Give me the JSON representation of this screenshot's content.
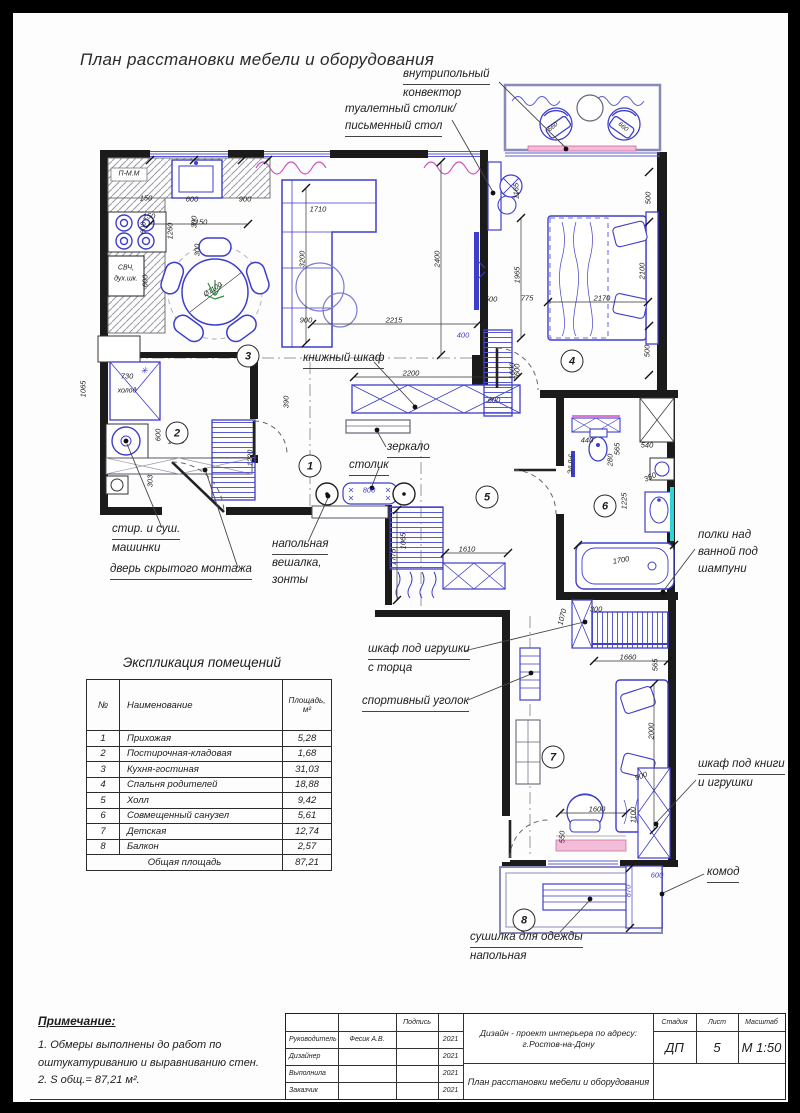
{
  "page": {
    "title": "План расстановки мебели и оборудования"
  },
  "colors": {
    "furniture_blue": "#3e3ecb",
    "wall_black": "#1b1b1b",
    "accent_magenta": "#cf4fc4",
    "accent_pink": "#f3bcd9",
    "accent_teal": "#2fd4d4",
    "plant_green": "#2f8f3f"
  },
  "plan": {
    "room_numbers": [
      {
        "n": "1",
        "x": 310,
        "y": 466
      },
      {
        "n": "2",
        "x": 177,
        "y": 433
      },
      {
        "n": "3",
        "x": 248,
        "y": 356
      },
      {
        "n": "4",
        "x": 572,
        "y": 361
      },
      {
        "n": "5",
        "x": 487,
        "y": 497
      },
      {
        "n": "6",
        "x": 605,
        "y": 506
      },
      {
        "n": "7",
        "x": 553,
        "y": 757
      },
      {
        "n": "8",
        "x": 524,
        "y": 920
      }
    ],
    "small_labels": [
      {
        "t": "П-М.М",
        "x": 129,
        "y": 174
      },
      {
        "t": "СВЧ,",
        "x": 126,
        "y": 268
      },
      {
        "t": "дух.шк.",
        "x": 126,
        "y": 279
      },
      {
        "t": "холод",
        "x": 127,
        "y": 391
      },
      {
        "t": "✳",
        "x": 144,
        "y": 371,
        "c": "b"
      },
      {
        "t": "Ø1100",
        "x": 213,
        "y": 290,
        "r": -32
      },
      {
        "t": "Эл.п-с",
        "x": 571,
        "y": 464,
        "r": -90
      }
    ],
    "dims": [
      {
        "t": "150",
        "x": 146,
        "y": 198
      },
      {
        "t": "600",
        "x": 192,
        "y": 199
      },
      {
        "t": "900",
        "x": 245,
        "y": 199
      },
      {
        "t": "150",
        "x": 149,
        "y": 216
      },
      {
        "t": "2150",
        "x": 199,
        "y": 222
      },
      {
        "t": "600",
        "x": 143,
        "y": 228,
        "r": -90
      },
      {
        "t": "300",
        "x": 194,
        "y": 222,
        "r": -90
      },
      {
        "t": "300",
        "x": 197,
        "y": 250,
        "r": -90
      },
      {
        "t": "1260",
        "x": 170,
        "y": 231,
        "r": -90
      },
      {
        "t": "600",
        "x": 145,
        "y": 281,
        "r": -90
      },
      {
        "t": "730",
        "x": 127,
        "y": 376
      },
      {
        "t": "900",
        "x": 104,
        "y": 387,
        "r": -90
      },
      {
        "t": "1065",
        "x": 83,
        "y": 389,
        "r": -90
      },
      {
        "t": "600",
        "x": 158,
        "y": 435,
        "r": -90
      },
      {
        "t": "1580",
        "x": 176,
        "y": 441
      },
      {
        "t": "1220",
        "x": 250,
        "y": 458,
        "r": -90
      },
      {
        "t": "303",
        "x": 150,
        "y": 481,
        "r": -90
      },
      {
        "t": "1710",
        "x": 318,
        "y": 209
      },
      {
        "t": "3200",
        "x": 302,
        "y": 259,
        "r": -90
      },
      {
        "t": "900",
        "x": 306,
        "y": 320
      },
      {
        "t": "2215",
        "x": 394,
        "y": 320
      },
      {
        "t": "2400",
        "x": 437,
        "y": 259,
        "r": -90
      },
      {
        "t": "500",
        "x": 491,
        "y": 299
      },
      {
        "t": "400",
        "x": 463,
        "y": 335,
        "c": "b"
      },
      {
        "t": "2200",
        "x": 411,
        "y": 373
      },
      {
        "t": "390",
        "x": 286,
        "y": 402,
        "r": -90
      },
      {
        "t": "600",
        "x": 494,
        "y": 400
      },
      {
        "t": "1600",
        "x": 512,
        "y": 371,
        "r": -90
      },
      {
        "t": "800",
        "x": 369,
        "y": 490,
        "c": "b"
      },
      {
        "t": "1775",
        "x": 393,
        "y": 557,
        "r": -90
      },
      {
        "t": "1065",
        "x": 403,
        "y": 541,
        "r": -90
      },
      {
        "t": "1610",
        "x": 467,
        "y": 549
      },
      {
        "t": "660",
        "x": 553,
        "y": 127,
        "r": -40,
        "s": 1
      },
      {
        "t": "660",
        "x": 623,
        "y": 127,
        "r": 40,
        "s": 1
      },
      {
        "t": "1165",
        "x": 516,
        "y": 191,
        "r": -90
      },
      {
        "t": "1965",
        "x": 517,
        "y": 275,
        "r": -90
      },
      {
        "t": "775",
        "x": 527,
        "y": 298
      },
      {
        "t": "2170",
        "x": 602,
        "y": 298
      },
      {
        "t": "2100",
        "x": 642,
        "y": 271,
        "r": -90
      },
      {
        "t": "500",
        "x": 648,
        "y": 198,
        "r": -90
      },
      {
        "t": "500",
        "x": 647,
        "y": 351,
        "r": -90
      },
      {
        "t": "600",
        "x": 517,
        "y": 370,
        "r": -90
      },
      {
        "t": "440",
        "x": 587,
        "y": 440
      },
      {
        "t": "565",
        "x": 617,
        "y": 449,
        "r": -90
      },
      {
        "t": "540",
        "x": 647,
        "y": 445
      },
      {
        "t": "280",
        "x": 610,
        "y": 460,
        "r": -90
      },
      {
        "t": "350",
        "x": 650,
        "y": 477,
        "r": -25
      },
      {
        "t": "1225",
        "x": 624,
        "y": 501,
        "r": -90
      },
      {
        "t": "1700",
        "x": 621,
        "y": 560,
        "r": -10
      },
      {
        "t": "300",
        "x": 596,
        "y": 609
      },
      {
        "t": "1070",
        "x": 562,
        "y": 617,
        "r": -75
      },
      {
        "t": "1660",
        "x": 628,
        "y": 657
      },
      {
        "t": "565",
        "x": 655,
        "y": 665,
        "r": -90
      },
      {
        "t": "2000",
        "x": 651,
        "y": 731,
        "r": -90
      },
      {
        "t": "900",
        "x": 641,
        "y": 776,
        "r": -20
      },
      {
        "t": "1600",
        "x": 597,
        "y": 809
      },
      {
        "t": "1100",
        "x": 633,
        "y": 815,
        "r": -90
      },
      {
        "t": "550",
        "x": 562,
        "y": 837,
        "r": -90
      },
      {
        "t": "600",
        "x": 657,
        "y": 875,
        "c": "b"
      },
      {
        "t": "870",
        "x": 628,
        "y": 891,
        "r": -90,
        "c": "b"
      }
    ],
    "annotations": [
      {
        "lines": [
          "внутрипольный",
          "конвектор"
        ],
        "x": 403,
        "y": 66,
        "u": 0
      },
      {
        "lines": [
          "туалетный столик/",
          "письменный стол"
        ],
        "x": 345,
        "y": 101,
        "u": 1
      },
      {
        "lines": [
          "книжный шкаф"
        ],
        "x": 303,
        "y": 350,
        "u": 0
      },
      {
        "lines": [
          "зеркало"
        ],
        "x": 387,
        "y": 439,
        "u": 0
      },
      {
        "lines": [
          "столик"
        ],
        "x": 349,
        "y": 457,
        "u": 0
      },
      {
        "lines": [
          "напольная",
          "вешалка,",
          "зонты"
        ],
        "x": 272,
        "y": 536,
        "u": 0
      },
      {
        "lines": [
          "стир. и суш.",
          "машинки"
        ],
        "x": 112,
        "y": 521,
        "u": 0
      },
      {
        "lines": [
          "дверь скрытого монтажа"
        ],
        "x": 110,
        "y": 561,
        "u": 0
      },
      {
        "lines": [
          "полки над",
          "ванной под",
          "шампуни"
        ],
        "x": 698,
        "y": 527,
        "u": -1
      },
      {
        "lines": [
          "шкаф под игрушки",
          "с торца"
        ],
        "x": 368,
        "y": 641,
        "u": 0
      },
      {
        "lines": [
          "спортивный уголок"
        ],
        "x": 362,
        "y": 693,
        "u": 0
      },
      {
        "lines": [
          "шкаф под книги",
          "и игрушки"
        ],
        "x": 698,
        "y": 756,
        "u": 0
      },
      {
        "lines": [
          "комод"
        ],
        "x": 707,
        "y": 864,
        "u": 0
      },
      {
        "lines": [
          "сушилка для одежды",
          "напольная"
        ],
        "x": 470,
        "y": 929,
        "u": 0
      }
    ]
  },
  "legend_table": {
    "title": "Экспликация помещений",
    "headers": {
      "num": "№",
      "name": "Наименование",
      "area1": "Площадь,",
      "area2": "м²"
    },
    "rows": [
      [
        "1",
        "Прихожая",
        "5,28"
      ],
      [
        "2",
        "Постирочная-кладовая",
        "1,68"
      ],
      [
        "3",
        "Кухня-гостиная",
        "31,03"
      ],
      [
        "4",
        "Спальня родителей",
        "18,88"
      ],
      [
        "5",
        "Холл",
        "9,42"
      ],
      [
        "6",
        "Совмещенный санузел",
        "5,61"
      ],
      [
        "7",
        "Детская",
        "12,74"
      ],
      [
        "8",
        "Балкон",
        "2,57"
      ]
    ],
    "total_label": "Общая площадь",
    "total_value": "87,21"
  },
  "notes": {
    "heading": "Примечание:",
    "lines": [
      "1. Обмеры выполнены до работ по",
      "оштукатуриванию и выравниванию стен.",
      "2. S общ.= 87,21 м²."
    ]
  },
  "titleblock": {
    "sign_header": "Подпись",
    "rows": [
      {
        "role": "Руководитель",
        "name": "Фесик А.В.",
        "year": "2021"
      },
      {
        "role": "Дизайнер",
        "name": "",
        "year": "2021"
      },
      {
        "role": "Выполнила",
        "name": "",
        "year": "2021"
      },
      {
        "role": "Заказчик",
        "name": "",
        "year": "2021"
      }
    ],
    "project_line1": "Дизайн - проект интерьера по адресу:",
    "project_line2": "г.Ростов-на-Дону",
    "sheet_title": "План расстановки мебели и оборудования",
    "stage_label": "Стадия",
    "stage": "ДП",
    "sheet_label": "Лист",
    "sheet": "5",
    "scale_label": "Масштаб",
    "scale": "М 1:50"
  }
}
